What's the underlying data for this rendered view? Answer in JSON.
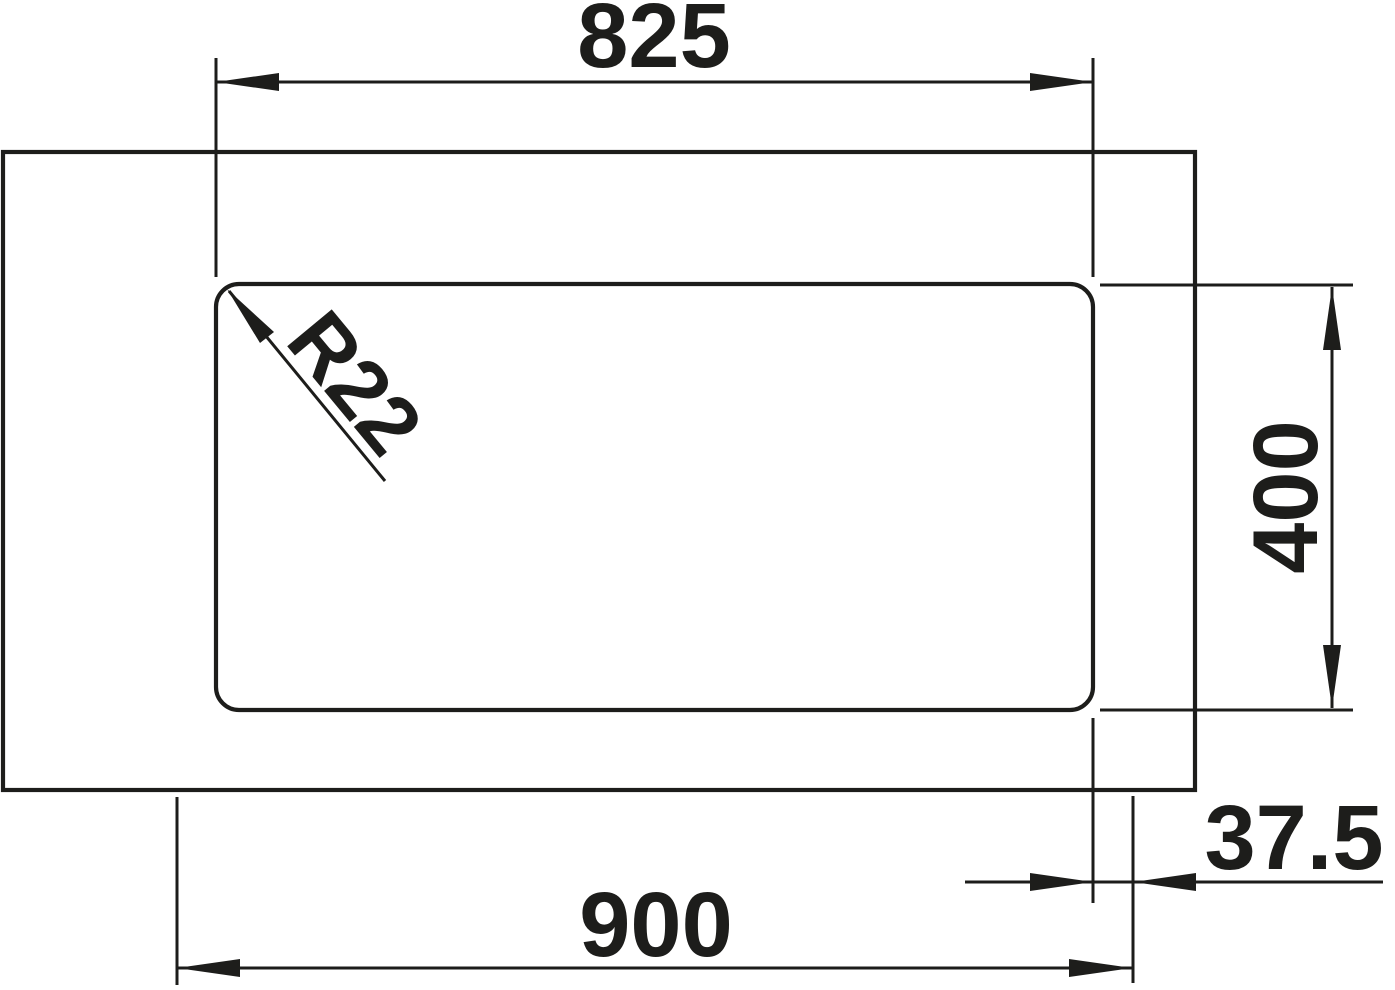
{
  "drawing": {
    "kind": "technical-dimension-drawing",
    "subject": "sink-cutout-installation-diagram",
    "colors": {
      "line": "#1d1d1b",
      "background": "#ffffff"
    },
    "dimensions": [
      {
        "id": "cutout-width",
        "label": "825"
      },
      {
        "id": "cutout-depth",
        "label": "400"
      },
      {
        "id": "overall-width",
        "label": "900"
      },
      {
        "id": "edge-offset",
        "label": "37.5"
      },
      {
        "id": "corner-radius",
        "label": "R22"
      }
    ]
  }
}
